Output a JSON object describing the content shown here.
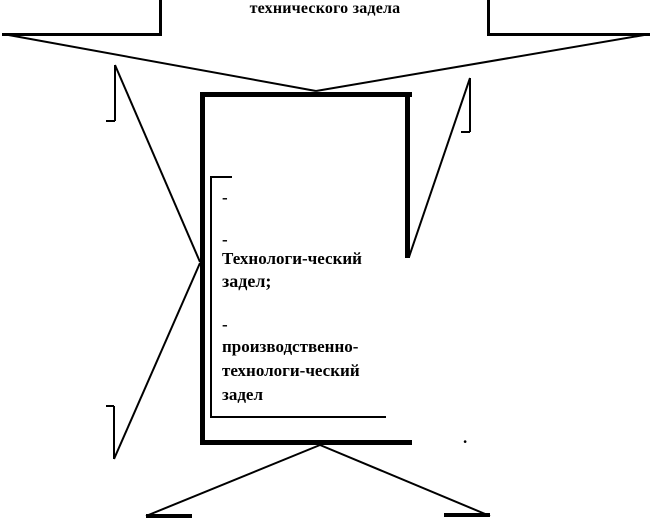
{
  "diagram": {
    "top_caption": "технического задела",
    "center_list": {
      "bullet_1": "-",
      "bullet_2": "-",
      "clipped_line": "Технологи-ческий",
      "line_after_clip": "задел;",
      "bullet_3": "-",
      "item3_line1": "производственно-",
      "item3_line2": "технологи-ческий",
      "item3_line3": "задел"
    },
    "stray_dot": ".",
    "colors": {
      "ink": "#000000",
      "background": "#ffffff"
    }
  }
}
